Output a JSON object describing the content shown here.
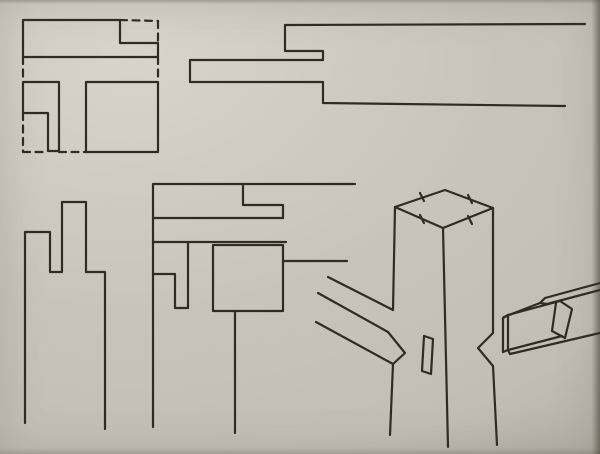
{
  "canvas": {
    "width": 600,
    "height": 454
  },
  "colors": {
    "paper": "#c8c4bc",
    "paper_highlight": "#d8d4cb",
    "paper_mid": "#c2beb6",
    "paper_shadow": "#aeaaa1",
    "ink": "#322b23"
  },
  "stroke": {
    "width": 2.2,
    "dash": "7 5.5"
  },
  "figures": [
    {
      "name": "plan-view-halved-corner-joint",
      "solid": [
        [
          [
            23,
            57
          ],
          [
            23,
            20
          ],
          [
            120,
            20
          ],
          [
            120,
            43
          ],
          [
            158,
            43
          ],
          [
            158,
            57
          ],
          [
            23,
            57
          ]
        ],
        [
          [
            23,
            82
          ],
          [
            59,
            82
          ],
          [
            59,
            151
          ],
          [
            48,
            151
          ],
          [
            48,
            113
          ],
          [
            23,
            113
          ],
          [
            23,
            82
          ]
        ],
        [
          [
            86,
            82
          ],
          [
            158,
            82
          ],
          [
            158,
            152
          ],
          [
            86,
            152
          ],
          [
            86,
            82
          ]
        ]
      ],
      "dashed": [
        [
          [
            120,
            20
          ],
          [
            158,
            21
          ]
        ],
        [
          [
            158,
            21
          ],
          [
            158,
            43
          ]
        ],
        [
          [
            158,
            57
          ],
          [
            158,
            82
          ]
        ],
        [
          [
            23,
            57
          ],
          [
            23,
            82
          ]
        ],
        [
          [
            23,
            113
          ],
          [
            23,
            152
          ]
        ],
        [
          [
            23,
            152
          ],
          [
            48,
            152
          ]
        ],
        [
          [
            59,
            152
          ],
          [
            86,
            152
          ]
        ]
      ]
    },
    {
      "name": "side-profile-lap-joint",
      "solid": [
        [
          [
            585,
            24
          ],
          [
            285,
            25
          ],
          [
            285,
            51
          ],
          [
            323,
            51
          ],
          [
            323,
            60
          ],
          [
            190,
            60
          ],
          [
            190,
            82
          ],
          [
            323,
            82
          ],
          [
            323,
            103
          ],
          [
            565,
            106
          ]
        ]
      ],
      "dashed": []
    },
    {
      "name": "end-profile-double-notch",
      "solid": [
        [
          [
            25,
            423
          ],
          [
            25,
            232
          ],
          [
            50,
            232
          ],
          [
            50,
            272
          ],
          [
            62,
            272
          ],
          [
            62,
            202
          ],
          [
            86,
            202
          ],
          [
            86,
            272
          ],
          [
            105,
            272
          ],
          [
            105,
            429
          ]
        ]
      ],
      "dashed": []
    },
    {
      "name": "elevation-mortise-and-tenon",
      "solid": [
        [
          [
            153,
            427
          ],
          [
            153,
            184
          ],
          [
            355,
            184
          ]
        ],
        [
          [
            243,
            184
          ],
          [
            243,
            205
          ],
          [
            283,
            205
          ],
          [
            283,
            218
          ]
        ],
        [
          [
            153,
            218
          ],
          [
            283,
            218
          ]
        ],
        [
          [
            153,
            242
          ],
          [
            286,
            242
          ]
        ],
        [
          [
            153,
            274
          ],
          [
            175,
            274
          ],
          [
            175,
            308
          ],
          [
            188,
            308
          ],
          [
            188,
            243
          ]
        ],
        [
          [
            213,
            245
          ],
          [
            283,
            245
          ],
          [
            283,
            311
          ],
          [
            213,
            311
          ],
          [
            213,
            245
          ]
        ],
        [
          [
            235,
            311
          ],
          [
            235,
            433
          ]
        ],
        [
          [
            283,
            261
          ],
          [
            347,
            261
          ]
        ]
      ],
      "dashed": []
    },
    {
      "name": "isometric-post-with-rails-mortise-tenon",
      "solid": [
        [
          [
            395,
            207
          ],
          [
            445,
            190
          ],
          [
            493,
            208
          ],
          [
            443,
            228
          ],
          [
            395,
            207
          ]
        ],
        [
          [
            420,
            193
          ],
          [
            424,
            201
          ]
        ],
        [
          [
            468,
            195
          ],
          [
            472,
            203
          ]
        ],
        [
          [
            420,
            215
          ],
          [
            424,
            223
          ]
        ],
        [
          [
            468,
            216
          ],
          [
            472,
            224
          ]
        ],
        [
          [
            395,
            207
          ],
          [
            393,
            310
          ]
        ],
        [
          [
            393,
            364
          ],
          [
            390,
            435
          ]
        ],
        [
          [
            443,
            228
          ],
          [
            448,
            447
          ]
        ],
        [
          [
            493,
            208
          ],
          [
            493,
            333
          ]
        ],
        [
          [
            493,
            333
          ],
          [
            478,
            348
          ],
          [
            493,
            366
          ]
        ],
        [
          [
            493,
            366
          ],
          [
            497,
            445
          ]
        ],
        [
          [
            424,
            336
          ],
          [
            433,
            339
          ],
          [
            431,
            374
          ],
          [
            422,
            371
          ],
          [
            424,
            336
          ]
        ],
        [
          [
            328,
            277
          ],
          [
            393,
            310
          ]
        ],
        [
          [
            318,
            293
          ],
          [
            388,
            332
          ]
        ],
        [
          [
            316,
            322
          ],
          [
            393,
            364
          ]
        ],
        [
          [
            388,
            332
          ],
          [
            405,
            353
          ],
          [
            393,
            364
          ]
        ],
        [
          [
            600,
            283
          ],
          [
            545,
            298
          ]
        ],
        [
          [
            545,
            298
          ],
          [
            540,
            303
          ],
          [
            547,
            304
          ]
        ],
        [
          [
            540,
            303
          ],
          [
            504,
            317
          ]
        ],
        [
          [
            503,
            318
          ],
          [
            503,
            352
          ]
        ],
        [
          [
            503,
            318
          ],
          [
            508,
            315
          ]
        ],
        [
          [
            503,
            352
          ],
          [
            508,
            350
          ]
        ],
        [
          [
            508,
            315
          ],
          [
            508,
            350
          ]
        ],
        [
          [
            508,
            315
          ],
          [
            560,
            301
          ]
        ],
        [
          [
            508,
            350
          ],
          [
            562,
            336
          ]
        ],
        [
          [
            560,
            301
          ],
          [
            572,
            309
          ],
          [
            565,
            338
          ]
        ],
        [
          [
            556,
            303
          ],
          [
            552,
            331
          ],
          [
            565,
            338
          ]
        ],
        [
          [
            547,
            304
          ],
          [
            600,
            290
          ]
        ],
        [
          [
            510,
            354
          ],
          [
            600,
            333
          ]
        ],
        [
          [
            508,
            350
          ],
          [
            510,
            354
          ]
        ]
      ],
      "dashed": []
    }
  ]
}
